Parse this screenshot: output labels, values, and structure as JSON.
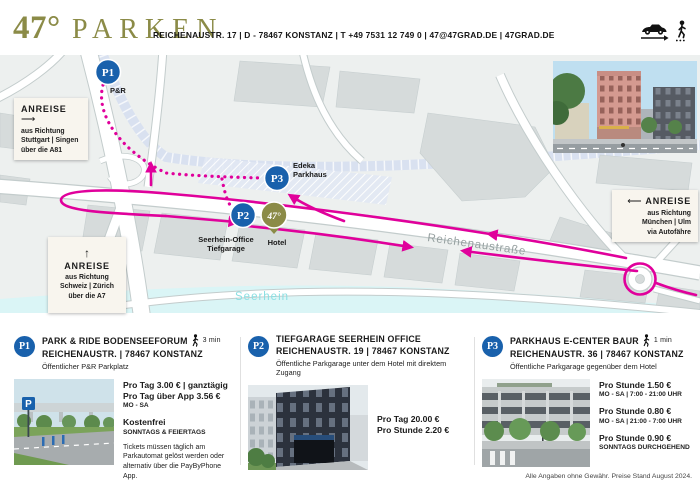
{
  "header": {
    "logo_number": "47°",
    "logo_word": "PARKEN",
    "contact": "REICHENAUSTR. 17 | D - 78467 KONSTANZ | T +49 7531 12 749 0 | 47@47GRAD.DE | 47GRAD.DE"
  },
  "map": {
    "street": "Reichenaustraße",
    "water": "Seerhein",
    "p1": {
      "id": "P1",
      "label": "P&R"
    },
    "p2": {
      "id": "P2",
      "label_line1": "Seerhein-Office",
      "label_line2": "Tiefgarage"
    },
    "p3": {
      "id": "P3",
      "label_line1": "Edeka",
      "label_line2": "Parkhaus"
    },
    "hotel": {
      "pin": "47°",
      "label": "Hotel"
    },
    "anreise_left": {
      "title": "ANREISE",
      "arrow": "⟶",
      "l1": "aus Richtung",
      "l2": "Stuttgart | Singen",
      "l3": "über die A81"
    },
    "anreise_bottom": {
      "title": "ANREISE",
      "arrow": "↑",
      "l1": "aus Richtung",
      "l2": "Schweiz | Zürich",
      "l3": "über die A7"
    },
    "anreise_right": {
      "title": "ANREISE",
      "arrow": "⟵",
      "l1": "aus Richtung",
      "l2": "München | Ulm",
      "l3": "via Autofähre"
    }
  },
  "cards": [
    {
      "badge": "P1",
      "title": "PARK & RIDE BODENSEEFORUM",
      "walk": "3 min",
      "address": "REICHENAUSTR. | 78467 KONSTANZ",
      "subtitle": "Öffentlicher P&R Parkplatz",
      "price1": "Pro Tag 3.00 € | ganztägig",
      "price2": "Pro Tag über App 3.56 €",
      "price2_sub": "MO - SA",
      "price3": "Kostenfrei",
      "price3_sub": "SONNTAGS & FEIERTAGS",
      "note": "Tickets müssen täglich am Parkautomat gelöst werden oder alternativ über die PayByPhone App."
    },
    {
      "badge": "P2",
      "title": "TIEFGARAGE SEERHEIN OFFICE",
      "address": "REICHENAUSTR. 19 | 78467 KONSTANZ",
      "subtitle": "Öffentliche Parkgarage unter dem Hotel mit direktem Zugang",
      "price1": "Pro Tag 20.00 €",
      "price2": "Pro Stunde 2.20 €"
    },
    {
      "badge": "P3",
      "title": "PARKHAUS E-CENTER BAUR",
      "walk": "1 min",
      "address": "REICHENAUSTR. 36 | 78467 KONSTANZ",
      "subtitle": "Öffentliche Parkgarage gegenüber dem Hotel",
      "price1": "Pro Stunde 1.50 €",
      "price1_sub": "MO - SA | 7:00 - 21:00 UHR",
      "price2": "Pro Stunde 0.80 €",
      "price2_sub": "MO - SA | 21:00 - 7:00 UHR",
      "price3": "Pro Stunde 0.90 €",
      "price3_sub": "SONNTAGS DURCHGEHEND"
    }
  ],
  "footer": "Alle Angaben ohne Gewähr. Preise Stand August 2024.",
  "colors": {
    "brand_olive": "#8b8b47",
    "route_magenta": "#e0009b",
    "marker_blue": "#1961ac",
    "water": "#daf5f6"
  }
}
